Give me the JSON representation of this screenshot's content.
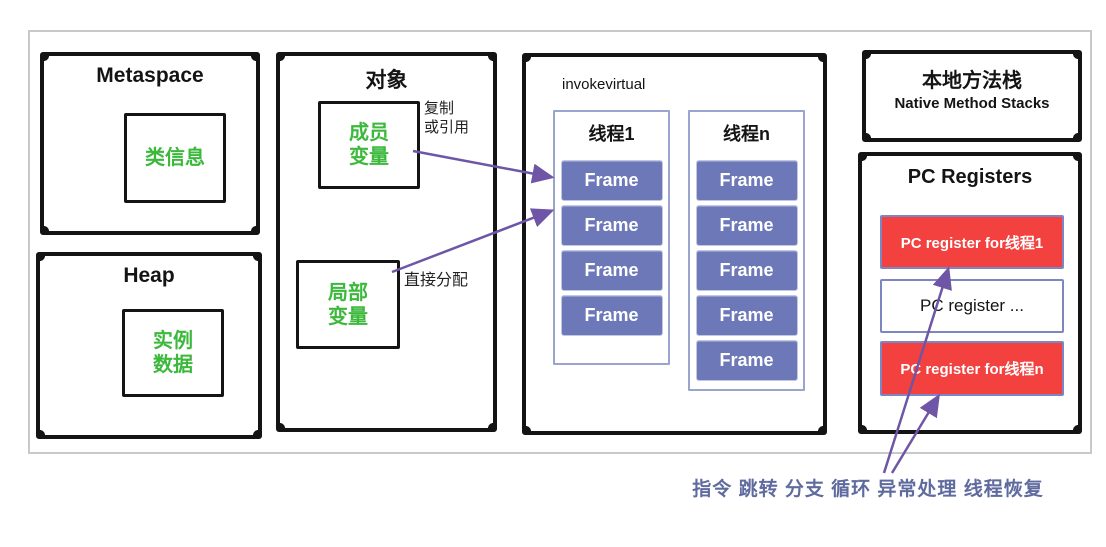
{
  "colors": {
    "green_text": "#3cb93c",
    "frame_blue": "#6d78b9",
    "container_border": "#9aa4cf",
    "red_register": "#f2413e",
    "arrow_purple": "#6f55a5",
    "caption_blue": "#5f6b9e",
    "box_black": "#141414",
    "outer_frame_gray": "#c9c9c9"
  },
  "metaspace": {
    "title": "Metaspace",
    "inner_label": "类信息"
  },
  "heap": {
    "title": "Heap",
    "inner_line1": "实例",
    "inner_line2": "数据"
  },
  "object": {
    "title": "对象",
    "member_line1": "成员",
    "member_line2": "变量",
    "local_line1": "局部",
    "local_line2": "变量",
    "copy_label_line1": "复制",
    "copy_label_line2": "或引用",
    "direct_label": "直接分配"
  },
  "stacks": {
    "invoke_label": "invokevirtual",
    "thread1": {
      "title": "线程1",
      "frames": [
        "Frame",
        "Frame",
        "Frame",
        "Frame"
      ]
    },
    "threadn": {
      "title": "线程n",
      "frames": [
        "Frame",
        "Frame",
        "Frame",
        "Frame",
        "Frame"
      ]
    }
  },
  "native": {
    "title": "本地方法栈",
    "subtitle": "Native Method Stacks"
  },
  "pc_registers": {
    "title": "PC Registers",
    "reg_thread1": "PC register for线程1",
    "reg_middle": "PC register ...",
    "reg_threadn": "PC register for线程n"
  },
  "caption": "指令 跳转 分支 循环 异常处理  线程恢复"
}
